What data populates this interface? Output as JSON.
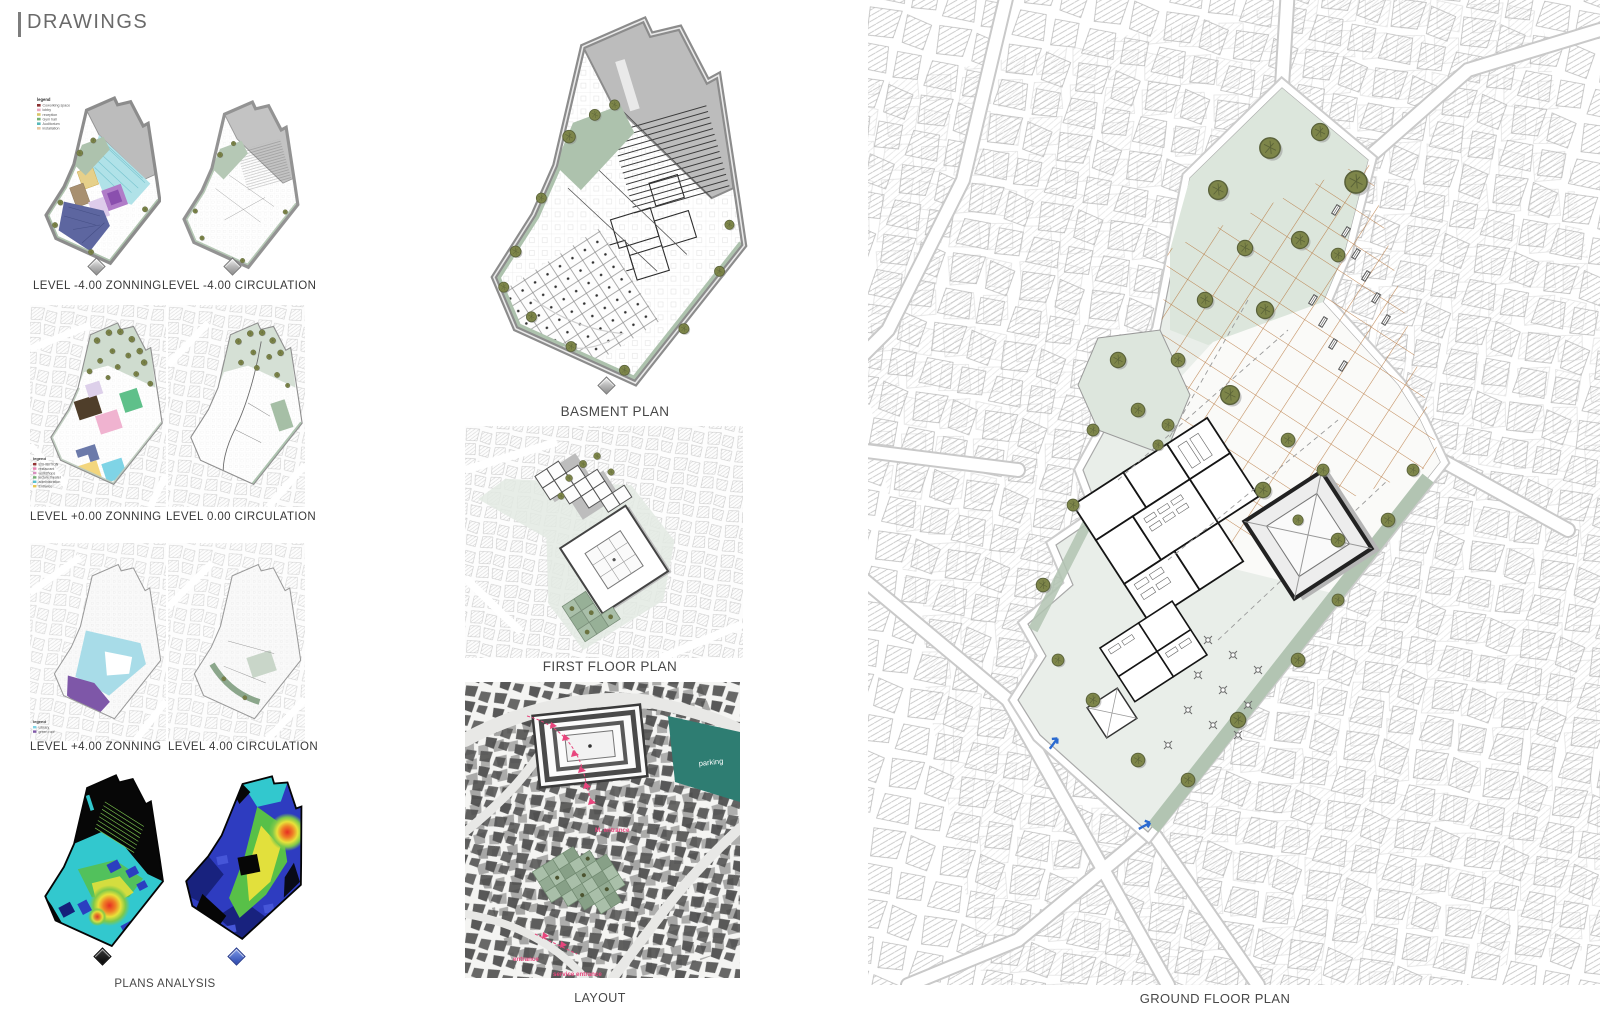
{
  "header": {
    "title": "DRAWINGS"
  },
  "sections": {
    "row1": {
      "left_label": "LEVEL -4.00 ZONNING",
      "right_label": "LEVEL -4.00 CIRCULATION"
    },
    "row2": {
      "left_label": "LEVEL +0.00 ZONNING",
      "right_label": "LEVEL 0.00 CIRCULATION"
    },
    "row3": {
      "left_label": "LEVEL +4.00 ZONNING",
      "right_label": "LEVEL 4.00 CIRCULATION"
    },
    "plans_analysis_caption": "PLANS ANALYSIS",
    "basement_caption": "BASMENT PLAN",
    "first_floor_caption": "FIRST FLOOR PLAN",
    "layout_caption": "LAYOUT",
    "ground_floor_caption": "GROUND FLOOR PLAN"
  },
  "legends": {
    "minus4": {
      "title": "legend",
      "items": [
        {
          "label": "Coworking space",
          "color": "#8a3030"
        },
        {
          "label": "lobby",
          "color": "#e8a8c0"
        },
        {
          "label": "reception",
          "color": "#d8c468"
        },
        {
          "label": "Gym hall",
          "color": "#74b074"
        },
        {
          "label": "Auditorium",
          "color": "#58b8b8"
        },
        {
          "label": "installation",
          "color": "#e8c8a0"
        }
      ]
    },
    "zero": {
      "title": "legend",
      "items": [
        {
          "label": "EXHIBITION",
          "color": "#943434"
        },
        {
          "label": "restaurant",
          "color": "#e884b4"
        },
        {
          "label": "workshops",
          "color": "#d890c0"
        },
        {
          "label": "lecture theater",
          "color": "#74b074"
        },
        {
          "label": "administration",
          "color": "#58c0d0"
        },
        {
          "label": "Entrance",
          "color": "#e8c854"
        }
      ]
    },
    "plus4": {
      "title": "legend",
      "items": [
        {
          "label": "Library",
          "color": "#7fd4e6"
        },
        {
          "label": "green roof",
          "color": "#8059a8"
        }
      ]
    }
  },
  "layout_plan": {
    "parking_label": "parking",
    "main_entrance_label": "M. entrance",
    "entrance_label": "entrance",
    "service_entrance_label": "service entrance"
  },
  "palette": {
    "site_green": "#dfe8df",
    "band_green": "#aec4b0",
    "tree_olive": "#7d8549",
    "grid_orange": "#b5743a",
    "parking_teal": "#2e7d72",
    "annotation_pink": "#e8457d",
    "roof_gray": "#bdbdbd",
    "outline_gray": "#8a8a8a",
    "heat_cyan": "#32c8ce",
    "heat_blue": "#2b3fc0",
    "heat_green": "#58c048",
    "heat_yellow": "#e2e03c",
    "heat_red": "#e62e22"
  }
}
